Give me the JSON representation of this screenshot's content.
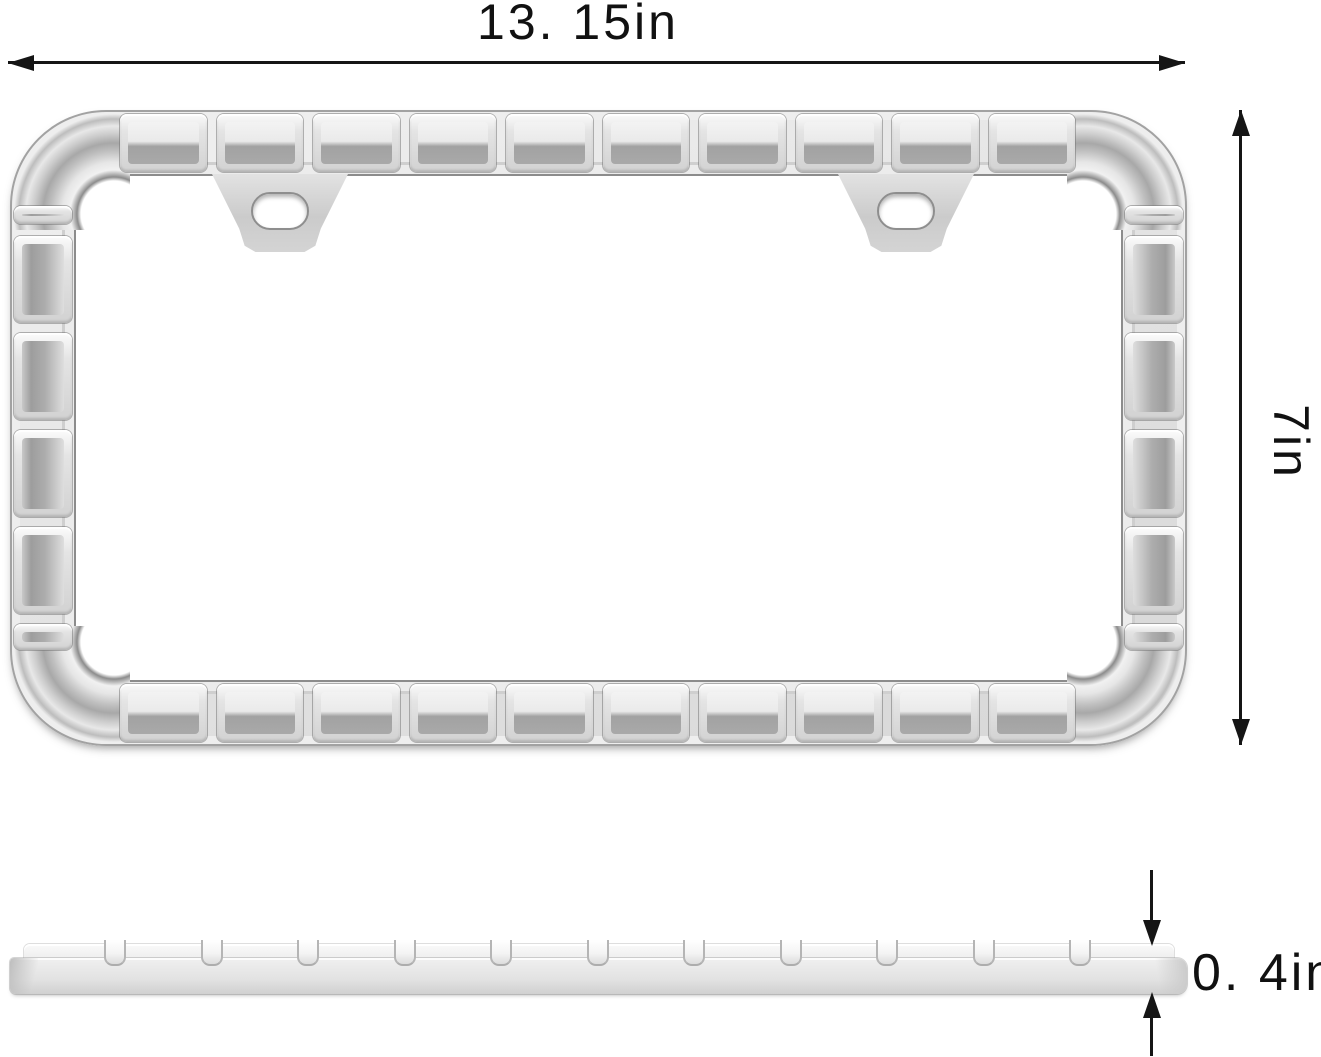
{
  "figure": {
    "type": "product-dimension-diagram",
    "subject": "license plate frame, front view and side profile view"
  },
  "dimensions": {
    "width": {
      "label": "13. 15in",
      "value_in": 13.15
    },
    "height": {
      "label": "7in",
      "value_in": 7
    },
    "thickness": {
      "label": "0. 4in",
      "value_in": 0.4
    }
  },
  "colors": {
    "background": "#ffffff",
    "dimension_line": "#151515",
    "frame_base": "#dcdcdc",
    "frame_highlight": "#f3f3f3",
    "frame_shadow": "#a5a5a5",
    "frame_outline": "#8c8c8c"
  },
  "icons": {
    "arrowheads": [
      "arrow-left-icon",
      "arrow-right-icon",
      "arrow-up-icon",
      "arrow-down-icon"
    ]
  }
}
